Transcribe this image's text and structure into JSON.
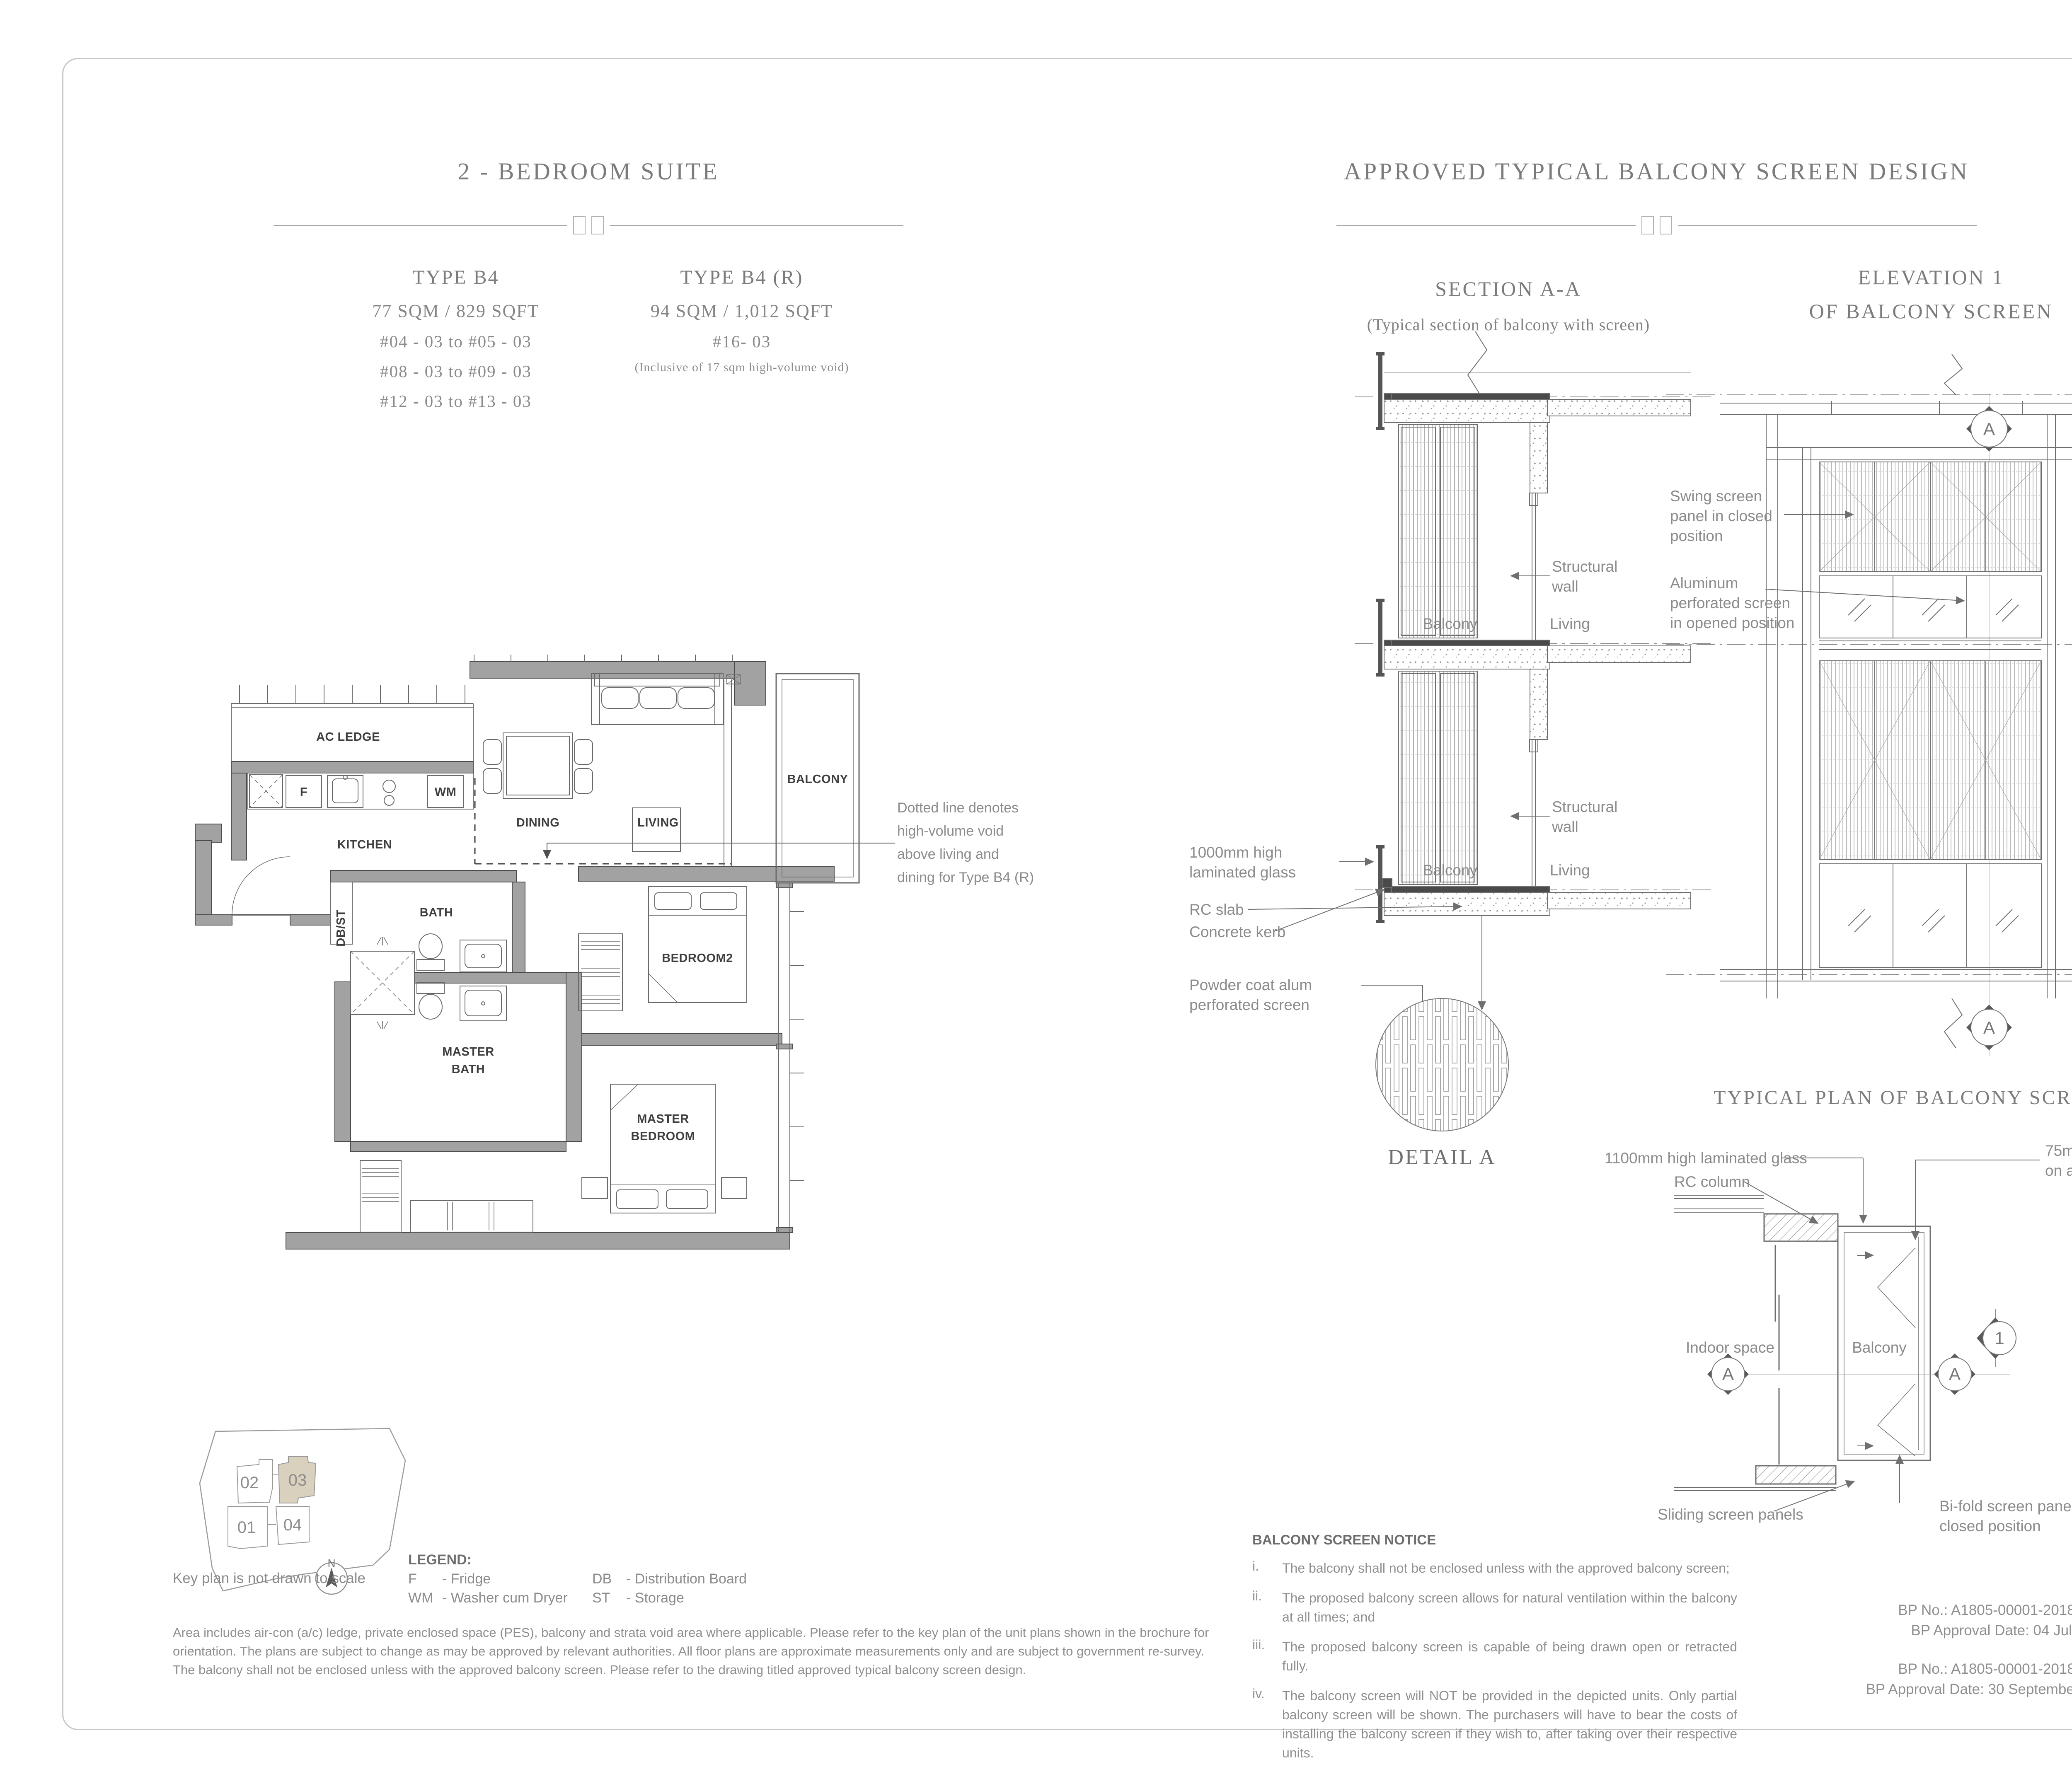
{
  "left_col": {
    "title": "2 - BEDROOM SUITE",
    "type_a": {
      "heading": "TYPE B4",
      "area": "77 SQM / 829 SQFT",
      "units": [
        "#04 - 03 to #05 - 03",
        "#08 - 03 to #09 - 03",
        "#12 - 03 to #13 - 03"
      ]
    },
    "type_b": {
      "heading": "TYPE B4 (R)",
      "area": "94 SQM / 1,012 SQFT",
      "unit": "#16- 03",
      "note": "(Inclusive of 17 sqm high-volume void)"
    },
    "void_note": {
      "l1": "Dotted line denotes",
      "l2": "high-volume void",
      "l3": "above living and",
      "l4": "dining for Type B4 (R)"
    }
  },
  "plan_labels": {
    "ac_ledge": "AC LEDGE",
    "kitchen": "KITCHEN",
    "dining": "DINING",
    "living": "LIVING",
    "balcony": "BALCONY",
    "bath": "BATH",
    "mbath1": "MASTER",
    "mbath2": "BATH",
    "bedroom2": "BEDROOM2",
    "mbed1": "MASTER",
    "mbed2": "BEDROOM",
    "dbst": "DB/ST",
    "f": "F",
    "wm": "WM"
  },
  "right_col": {
    "title": "APPROVED TYPICAL BALCONY SCREEN DESIGN",
    "section": {
      "title": "SECTION A-A",
      "subtitle": "(Typical section of balcony with screen)",
      "labels": {
        "sw1": "Structural",
        "sw2": "wall",
        "balcony": "Balcony",
        "living": "Living",
        "glass1": "1000mm high",
        "glass2": "laminated glass",
        "rcslab": "RC slab",
        "kerb": "Concrete kerb",
        "powder1": "Powder coat alum",
        "powder2": "perforated screen",
        "detail": "DETAIL A"
      }
    },
    "elevation": {
      "title": "ELEVATION 1",
      "subtitle": "OF BALCONY SCREEN",
      "labels": {
        "swing1": "Swing screen",
        "swing2": "panel in closed",
        "swing3": "position",
        "alum1": "Aluminum",
        "alum2": "perforated screen",
        "alum3": "in opened position",
        "a": "A"
      }
    },
    "typical_plan": {
      "title": "TYPICAL PLAN OF BALCONY SCREEN",
      "labels": {
        "glass": "1100mm high laminated glass",
        "rccol": "RC column",
        "kerb1": "75mm high concrete kerb",
        "kerb2": "on alum clad finish",
        "indoor": "Indoor space",
        "balcony": "Balcony",
        "sliding": "Sliding screen panels",
        "bifold1": "Bi-fold screen panels",
        "bifold2": "closed position",
        "a": "A",
        "one": "1"
      }
    }
  },
  "footer": {
    "keyplan": {
      "caption": "Key plan is not drawn to scale",
      "north": "N",
      "u01": "01",
      "u02": "02",
      "u03": "03",
      "u04": "04"
    },
    "legend": {
      "title": "LEGEND:",
      "f_abbr": "F",
      "f_term": "- Fridge",
      "wm_abbr": "WM",
      "wm_term": "- Washer cum Dryer",
      "db_abbr": "DB",
      "db_term": "- Distribution Board",
      "st_abbr": "ST",
      "st_term": "- Storage"
    },
    "disclaimer_1": "Area includes air-con (a/c) ledge, private enclosed space (PES), balcony and strata void area where applicable. Please refer to the key plan of the unit plans shown in the brochure for",
    "disclaimer_2": "orientation. The plans are subject to change as may be approved by relevant authorities. All floor plans are approximate measurements only and are subject to government re-survey.",
    "disclaimer_3": "The balcony shall not be enclosed unless with the approved balcony screen. Please refer to the drawing titled approved typical balcony screen design.",
    "notice": {
      "title": "BALCONY SCREEN NOTICE",
      "items": [
        {
          "num": "i.",
          "text": "The balcony shall not be enclosed unless with the approved balcony screen;"
        },
        {
          "num": "ii.",
          "text": "The proposed balcony screen allows for natural ventilation within the balcony at all times; and"
        },
        {
          "num": "iii.",
          "text": "The proposed balcony screen is capable of being drawn open or retracted fully."
        },
        {
          "num": "iv.",
          "text": "The balcony screen will NOT be provided in the depicted units. Only partial balcony screen will be shown. The purchasers will have to bear the costs of installing the balcony screen if they wish to, after taking over their respective units."
        }
      ]
    },
    "bp": {
      "no1": "BP No.: A1805-00001-2018-BP01",
      "date1": "BP Approval Date: 04 July 2019",
      "no2": "BP No.: A1805-00001-2018-BP02",
      "date2": "BP Approval Date: 30 September 2019"
    }
  },
  "colors": {
    "accent_beige": "#d9d0bd",
    "wall_gray": "#a2a2a2",
    "line_gray": "#6e6e6e",
    "text_gray": "#8b8b8b",
    "dark_label": "#3e3e3e"
  }
}
